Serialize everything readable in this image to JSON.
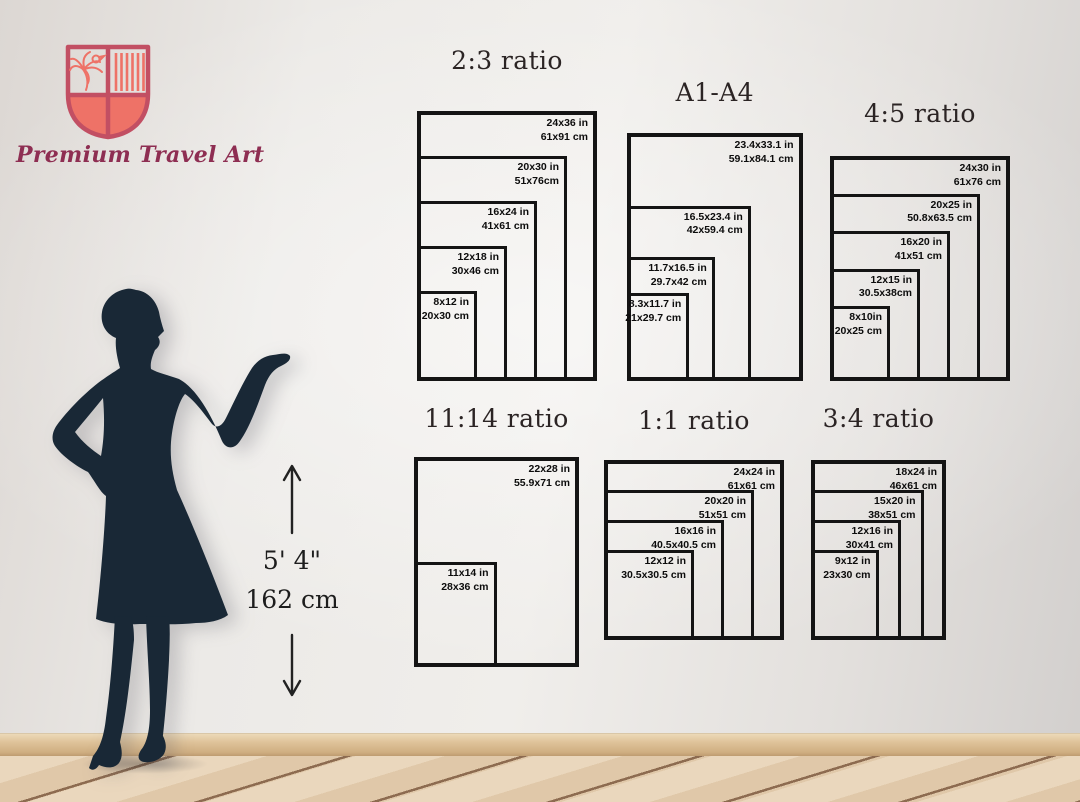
{
  "brand": {
    "name": "Premium Travel Art"
  },
  "height_reference": {
    "imperial": "5' 4\"",
    "metric": "162 cm"
  },
  "icons": {
    "logo": "shield-crest-icon",
    "height_up": "arrow-up-icon",
    "height_down": "arrow-down-icon",
    "figure": "woman-silhouette"
  },
  "colors": {
    "frame_black": "#141414",
    "brand_coral": "#ee7267",
    "brand_border": "#c24f63",
    "brand_text": "#8e2e52",
    "silhouette_navy": "#192836"
  },
  "size_groups": [
    {
      "id": "2-3",
      "title": "2:3 ratio",
      "sizes": [
        {
          "label_in": "24x36 in",
          "label_cm": "61x91 cm",
          "w": 24,
          "h": 36
        },
        {
          "label_in": "20x30 in",
          "label_cm": "51x76cm",
          "w": 20,
          "h": 30
        },
        {
          "label_in": "16x24 in",
          "label_cm": "41x61 cm",
          "w": 16,
          "h": 24
        },
        {
          "label_in": "12x18 in",
          "label_cm": "30x46 cm",
          "w": 12,
          "h": 18
        },
        {
          "label_in": "8x12 in",
          "label_cm": "20x30 cm",
          "w": 8,
          "h": 12
        }
      ]
    },
    {
      "id": "a1-a4",
      "title": "A1-A4",
      "sizes": [
        {
          "label_in": "23.4x33.1 in",
          "label_cm": "59.1x84.1 cm",
          "w": 23.4,
          "h": 33.1
        },
        {
          "label_in": "16.5x23.4 in",
          "label_cm": "42x59.4 cm",
          "w": 16.5,
          "h": 23.4
        },
        {
          "label_in": "11.7x16.5 in",
          "label_cm": "29.7x42 cm",
          "w": 11.7,
          "h": 16.5
        },
        {
          "label_in": "8.3x11.7 in",
          "label_cm": "21x29.7 cm",
          "w": 8.3,
          "h": 11.7
        }
      ]
    },
    {
      "id": "4-5",
      "title": "4:5 ratio",
      "sizes": [
        {
          "label_in": "24x30 in",
          "label_cm": "61x76 cm",
          "w": 24,
          "h": 30
        },
        {
          "label_in": "20x25 in",
          "label_cm": "50.8x63.5 cm",
          "w": 20,
          "h": 25
        },
        {
          "label_in": "16x20 in",
          "label_cm": "41x51 cm",
          "w": 16,
          "h": 20
        },
        {
          "label_in": "12x15 in",
          "label_cm": "30.5x38cm",
          "w": 12,
          "h": 15
        },
        {
          "label_in": "8x10in",
          "label_cm": "20x25 cm",
          "w": 8,
          "h": 10
        }
      ]
    },
    {
      "id": "11-14",
      "title": "11:14 ratio",
      "sizes": [
        {
          "label_in": "22x28 in",
          "label_cm": "55.9x71 cm",
          "w": 22,
          "h": 28
        },
        {
          "label_in": "11x14 in",
          "label_cm": "28x36 cm",
          "w": 11,
          "h": 14
        }
      ]
    },
    {
      "id": "1-1",
      "title": "1:1 ratio",
      "sizes": [
        {
          "label_in": "24x24 in",
          "label_cm": "61x61 cm",
          "w": 24,
          "h": 24
        },
        {
          "label_in": "20x20 in",
          "label_cm": "51x51 cm",
          "w": 20,
          "h": 20
        },
        {
          "label_in": "16x16 in",
          "label_cm": "40.5x40.5 cm",
          "w": 16,
          "h": 16
        },
        {
          "label_in": "12x12 in",
          "label_cm": "30.5x30.5 cm",
          "w": 12,
          "h": 12
        }
      ]
    },
    {
      "id": "3-4",
      "title": "3:4 ratio",
      "sizes": [
        {
          "label_in": "18x24 in",
          "label_cm": "46x61 cm",
          "w": 18,
          "h": 24
        },
        {
          "label_in": "15x20 in",
          "label_cm": "38x51 cm",
          "w": 15,
          "h": 20
        },
        {
          "label_in": "12x16 in",
          "label_cm": "30x41 cm",
          "w": 12,
          "h": 16
        },
        {
          "label_in": "9x12 in",
          "label_cm": "23x30 cm",
          "w": 9,
          "h": 12
        }
      ]
    }
  ]
}
